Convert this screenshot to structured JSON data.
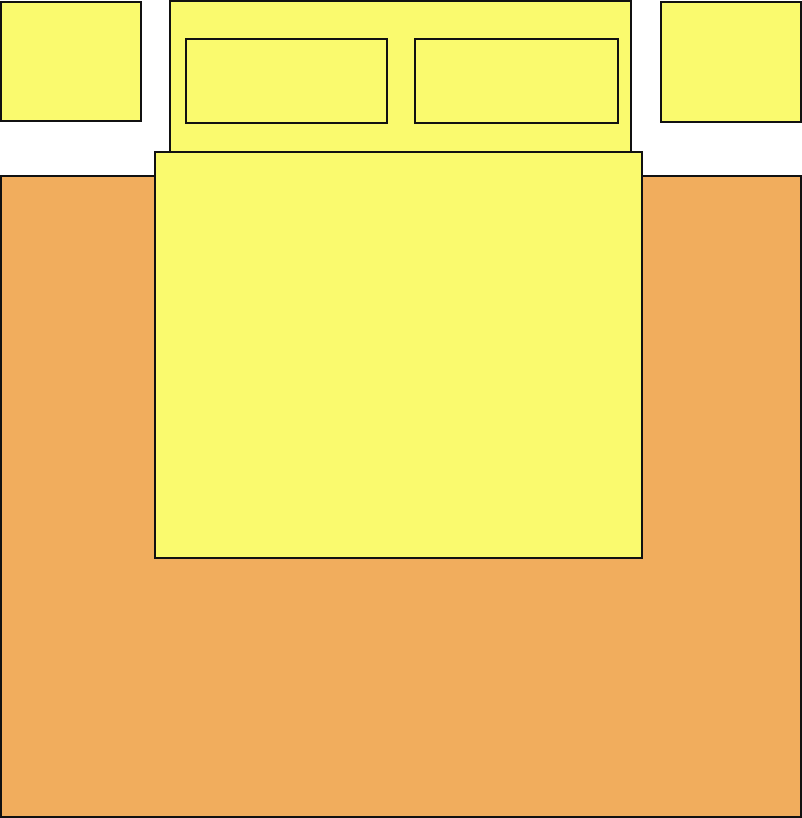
{
  "diagram": {
    "title": "Bedroom furniture layout plan",
    "canvas": {
      "width": 802,
      "height": 818,
      "background": "#FFFFFF"
    },
    "palette": {
      "furniture_yellow": "#FAFA6E",
      "rug_orange": "#F1AD5D",
      "outline_black": "#111111"
    },
    "items": [
      {
        "id": "rug",
        "label": "Rug",
        "fill": "#F1AD5D",
        "x": 0,
        "y": 175,
        "w": 802,
        "h": 643,
        "z": 1
      },
      {
        "id": "nightstand-left",
        "label": "Nightstand (left)",
        "fill": "#FAFA6E",
        "x": 0,
        "y": 1,
        "w": 142,
        "h": 121,
        "z": 2
      },
      {
        "id": "nightstand-right",
        "label": "Nightstand (right)",
        "fill": "#FAFA6E",
        "x": 660,
        "y": 1,
        "w": 142,
        "h": 122,
        "z": 2
      },
      {
        "id": "headboard",
        "label": "Bed headboard",
        "fill": "#FAFA6E",
        "x": 169,
        "y": 0,
        "w": 463,
        "h": 153,
        "z": 2
      },
      {
        "id": "pillow-left",
        "label": "Pillow (left)",
        "fill": "#FAFA6E",
        "x": 185,
        "y": 38,
        "w": 203,
        "h": 86,
        "z": 3
      },
      {
        "id": "pillow-right",
        "label": "Pillow (right)",
        "fill": "#FAFA6E",
        "x": 414,
        "y": 38,
        "w": 205,
        "h": 86,
        "z": 3
      },
      {
        "id": "bed",
        "label": "Bed mattress",
        "fill": "#FAFA6E",
        "x": 154,
        "y": 151,
        "w": 489,
        "h": 408,
        "z": 4
      }
    ]
  }
}
